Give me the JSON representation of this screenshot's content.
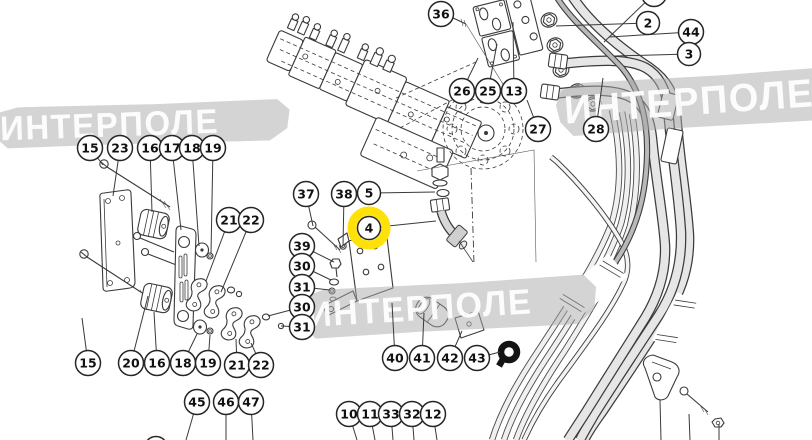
{
  "diagram": {
    "watermark": {
      "text": "ИНТЕРПОЛЕ"
    },
    "highlight_color": "#ffe10a",
    "highlighted_item": "4",
    "callouts": [
      {
        "label": "36",
        "x": 441,
        "y": 14,
        "tx": 452,
        "ty": 18
      },
      {
        "label": "28",
        "x": 654,
        "y": -6,
        "tx": 604,
        "ty": 42,
        "cut": true
      },
      {
        "label": "2",
        "x": 648,
        "y": 23,
        "tx": 556,
        "ty": 26
      },
      {
        "label": "44",
        "x": 691,
        "y": 32,
        "tx": 609,
        "ty": 37
      },
      {
        "label": "3",
        "x": 689,
        "y": 54,
        "tx": 614,
        "ty": 56
      },
      {
        "label": "26",
        "x": 462,
        "y": 91,
        "tx": 478,
        "ty": 58
      },
      {
        "label": "25",
        "x": 488,
        "y": 91,
        "tx": 497,
        "ty": 44
      },
      {
        "label": "13",
        "x": 514,
        "y": 91,
        "tx": 513,
        "ty": 22
      },
      {
        "label": "27",
        "x": 538,
        "y": 129,
        "tx": 527,
        "ty": 100
      },
      {
        "label": "28",
        "x": 596,
        "y": 129,
        "tx": 603,
        "ty": 78
      },
      {
        "label": "15",
        "x": 90,
        "y": 148,
        "tx": 103,
        "ty": 165
      },
      {
        "label": "23",
        "x": 120,
        "y": 148,
        "tx": 113,
        "ty": 196
      },
      {
        "label": "16",
        "x": 150,
        "y": 148,
        "tx": 152,
        "ty": 212
      },
      {
        "label": "17",
        "x": 172,
        "y": 148,
        "tx": 181,
        "ty": 230
      },
      {
        "label": "18",
        "x": 192,
        "y": 148,
        "tx": 199,
        "ty": 246
      },
      {
        "label": "19",
        "x": 213,
        "y": 148,
        "tx": 211,
        "ty": 253
      },
      {
        "label": "21",
        "x": 229,
        "y": 220,
        "tx": 206,
        "ty": 281
      },
      {
        "label": "22",
        "x": 251,
        "y": 220,
        "tx": 221,
        "ty": 292
      },
      {
        "label": "37",
        "x": 306,
        "y": 194,
        "tx": 313,
        "ty": 226
      },
      {
        "label": "38",
        "x": 344,
        "y": 194,
        "tx": 343,
        "ty": 246
      },
      {
        "label": "5",
        "x": 369,
        "y": 193,
        "tx": 435,
        "ty": 192
      },
      {
        "label": "4",
        "x": 369,
        "y": 228,
        "tx": 436,
        "ty": 221,
        "highlight": true
      },
      {
        "label": "39",
        "x": 302,
        "y": 246,
        "tx": 334,
        "ty": 262
      },
      {
        "label": "30",
        "x": 302,
        "y": 266,
        "tx": 331,
        "ty": 280
      },
      {
        "label": "31",
        "x": 302,
        "y": 287,
        "tx": 330,
        "ty": 290
      },
      {
        "label": "30",
        "x": 302,
        "y": 307,
        "tx": 268,
        "ty": 316
      },
      {
        "label": "31",
        "x": 302,
        "y": 327,
        "tx": 281,
        "ty": 326
      },
      {
        "label": "15",
        "x": 88,
        "y": 363,
        "tx": 82,
        "ty": 318
      },
      {
        "label": "20",
        "x": 131,
        "y": 363,
        "tx": 148,
        "ty": 296
      },
      {
        "label": "16",
        "x": 157,
        "y": 363,
        "tx": 154,
        "ty": 312
      },
      {
        "label": "18",
        "x": 183,
        "y": 363,
        "tx": 197,
        "ty": 334
      },
      {
        "label": "19",
        "x": 208,
        "y": 363,
        "tx": 210,
        "ty": 335
      },
      {
        "label": "21",
        "x": 237,
        "y": 365,
        "tx": 236,
        "ty": 339
      },
      {
        "label": "22",
        "x": 261,
        "y": 365,
        "tx": 251,
        "ty": 343
      },
      {
        "label": "45",
        "x": 197,
        "y": 402,
        "tx": 186,
        "ty": 440
      },
      {
        "label": "46",
        "x": 226,
        "y": 402,
        "tx": 226,
        "ty": 440
      },
      {
        "label": "47",
        "x": 251,
        "y": 402,
        "tx": 253,
        "ty": 440
      },
      {
        "label": "5",
        "x": 156,
        "y": 448,
        "cut": true
      },
      {
        "label": "10",
        "x": 349,
        "y": 414,
        "tx": 357,
        "ty": 440
      },
      {
        "label": "11",
        "x": 370,
        "y": 414,
        "tx": 375,
        "ty": 440
      },
      {
        "label": "33",
        "x": 391,
        "y": 414,
        "tx": 393,
        "ty": 440
      },
      {
        "label": "32",
        "x": 412,
        "y": 414,
        "tx": 414,
        "ty": 440
      },
      {
        "label": "12",
        "x": 433,
        "y": 414,
        "tx": 437,
        "ty": 440
      },
      {
        "label": "40",
        "x": 395,
        "y": 358,
        "tx": 392,
        "ty": 303
      },
      {
        "label": "41",
        "x": 422,
        "y": 358,
        "tx": 424,
        "ty": 313
      },
      {
        "label": "42",
        "x": 450,
        "y": 358,
        "tx": 462,
        "ty": 331
      },
      {
        "label": "43",
        "x": 477,
        "y": 358,
        "tx": 500,
        "ty": 352
      }
    ]
  }
}
